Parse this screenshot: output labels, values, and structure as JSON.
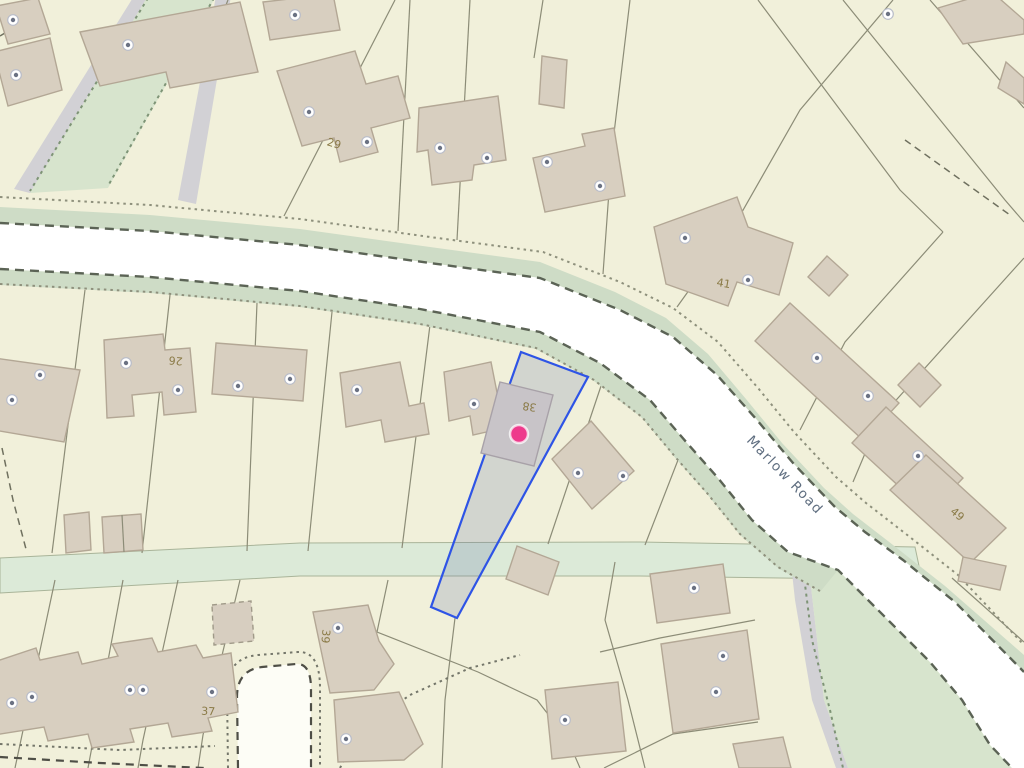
{
  "map": {
    "road_label": "Marlow Road",
    "selected_parcel": {
      "house_number": "38",
      "marker": {
        "x": 519,
        "y": 434,
        "radius": 9
      }
    },
    "house_numbers": [
      {
        "label": "29",
        "x": 333,
        "y": 147,
        "rotate": 17
      },
      {
        "label": "41",
        "x": 723,
        "y": 287,
        "rotate": 10
      },
      {
        "label": "26",
        "x": 176,
        "y": 357,
        "rotate": 185
      },
      {
        "label": "38",
        "x": 530,
        "y": 403,
        "rotate": 188,
        "color": "#6f665a"
      },
      {
        "label": "49",
        "x": 955,
        "y": 517,
        "rotate": 40
      },
      {
        "label": "39",
        "x": 322,
        "y": 636,
        "rotate": 95
      },
      {
        "label": "37",
        "x": 208,
        "y": 715,
        "rotate": 3
      }
    ],
    "address_points": [
      [
        13,
        20
      ],
      [
        16,
        75
      ],
      [
        128,
        45
      ],
      [
        295,
        15
      ],
      [
        888,
        14
      ],
      [
        309,
        112
      ],
      [
        367,
        142
      ],
      [
        440,
        148
      ],
      [
        487,
        158
      ],
      [
        547,
        162
      ],
      [
        600,
        186
      ],
      [
        685,
        238
      ],
      [
        748,
        280
      ],
      [
        817,
        358
      ],
      [
        868,
        396
      ],
      [
        918,
        456
      ],
      [
        12,
        400
      ],
      [
        40,
        375
      ],
      [
        126,
        363
      ],
      [
        178,
        390
      ],
      [
        238,
        386
      ],
      [
        290,
        379
      ],
      [
        357,
        390
      ],
      [
        474,
        404
      ],
      [
        578,
        473
      ],
      [
        623,
        476
      ],
      [
        338,
        628
      ],
      [
        346,
        739
      ],
      [
        565,
        720
      ],
      [
        694,
        588
      ],
      [
        723,
        656
      ],
      [
        716,
        692
      ],
      [
        12,
        703
      ],
      [
        32,
        697
      ],
      [
        130,
        690
      ],
      [
        143,
        690
      ],
      [
        212,
        692
      ]
    ],
    "colors": {
      "background": "#f1f0da",
      "parcel_line": "#8c8c77",
      "building_fill": "#d8cfc0",
      "building_stroke": "#b3a795",
      "road_fill": "#ffffff",
      "road_casing": "#5b6355",
      "verge_green": "#cedcc6",
      "green_area": "#d7e4cd",
      "gray_path": "#d2d1d5",
      "selected_fill": "rgba(98,118,168,0.22)",
      "selected_outline": "#2e54e6",
      "selected_building": "#c8c4c8",
      "marker": "#ee3a8c",
      "house_number": "#8a7a46",
      "road_label": "#5f6e80",
      "address_point_ring": "#b9bdc9",
      "address_point_center": "#6b7283"
    }
  }
}
